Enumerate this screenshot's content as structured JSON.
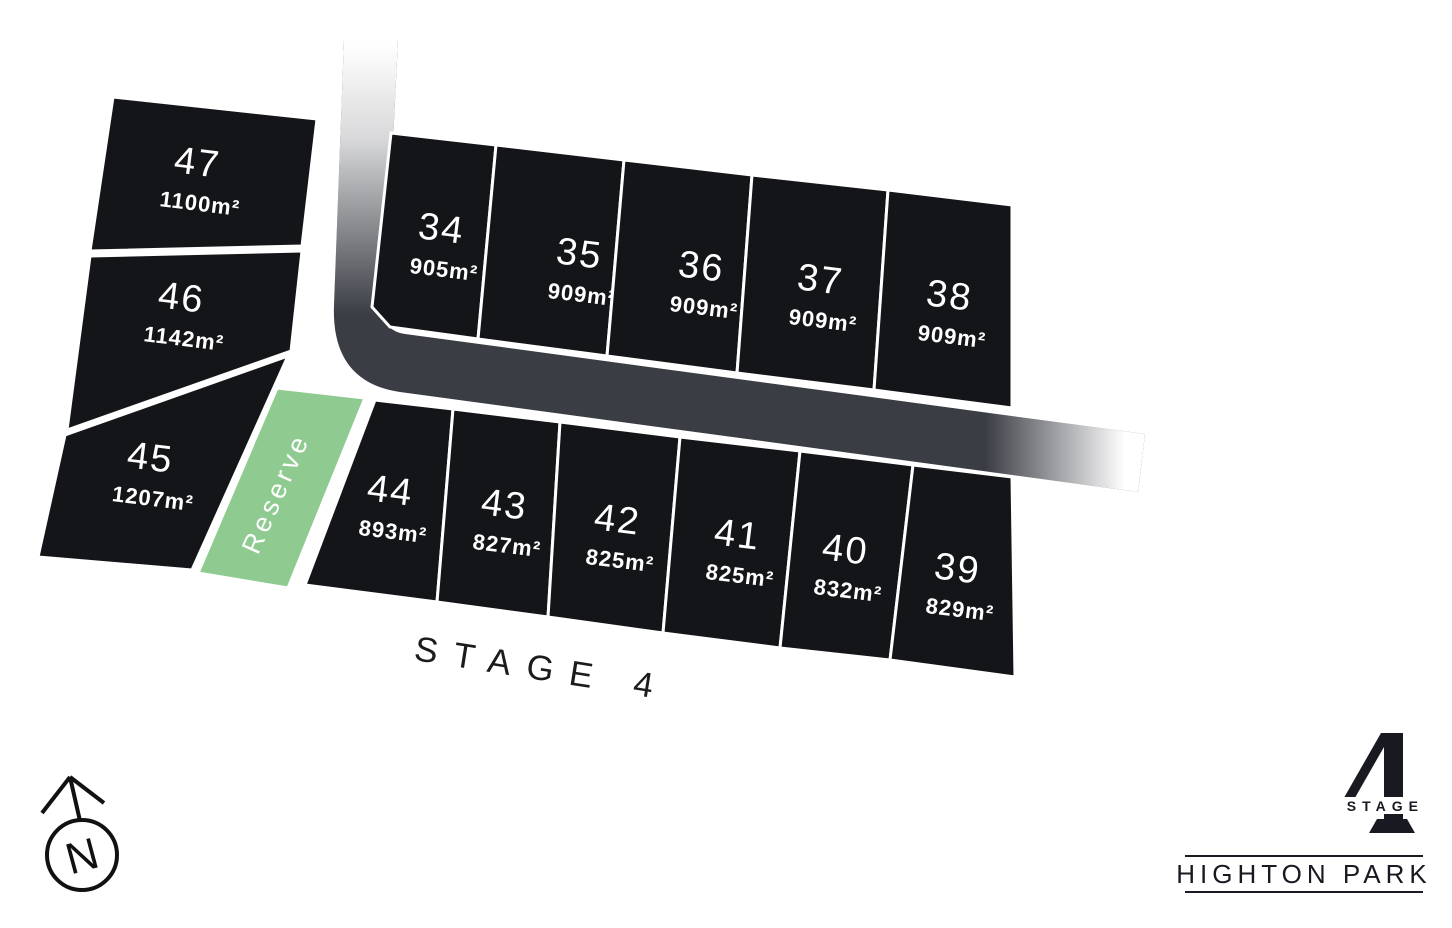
{
  "plan": {
    "stage_label": "STAGE 4",
    "reserve_label": "Reserve",
    "north_label": "N",
    "lots_left": [
      {
        "number": "47",
        "area": "1100m²"
      },
      {
        "number": "46",
        "area": "1142m²"
      },
      {
        "number": "45",
        "area": "1207m²"
      }
    ],
    "lots_top": [
      {
        "number": "34",
        "area": "905m²"
      },
      {
        "number": "35",
        "area": "909m²"
      },
      {
        "number": "36",
        "area": "909m²"
      },
      {
        "number": "37",
        "area": "909m²"
      },
      {
        "number": "38",
        "area": "909m²"
      }
    ],
    "lots_bottom": [
      {
        "number": "44",
        "area": "893m²"
      },
      {
        "number": "43",
        "area": "827m²"
      },
      {
        "number": "42",
        "area": "825m²"
      },
      {
        "number": "41",
        "area": "825m²"
      },
      {
        "number": "40",
        "area": "832m²"
      },
      {
        "number": "39",
        "area": "829m²"
      }
    ]
  },
  "logo": {
    "stage_word": "STAGE",
    "stage_number": "4",
    "brand_name": "HIGHTON PARK"
  },
  "colors": {
    "lot_fill": "#141519",
    "road_gray": "#3a3d44",
    "reserve_green": "#8fcb90",
    "ink": "#191922",
    "label_white": "#ffffff"
  }
}
